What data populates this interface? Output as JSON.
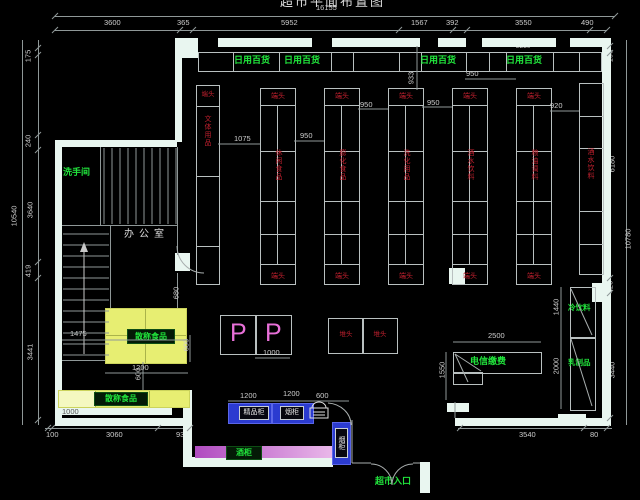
{
  "title_partial": "超市平面布置图",
  "colors": {
    "background": "#000000",
    "wall": "#e9f6f0",
    "line": "#8f9898",
    "green_text": "#21e43c",
    "red_text": "#c0202e",
    "yellow_area": "#e7ee72",
    "blue_counter": "#2b3bd0",
    "magenta_strip": "#c653cc",
    "pink_letter": "#e870d8"
  },
  "dims": {
    "top": {
      "overall": "16155",
      "segments": [
        "3600",
        "365",
        "5952",
        "1567",
        "392",
        "3550",
        "490"
      ],
      "sub": "2250"
    },
    "left": {
      "overall": "10540",
      "segments": [
        "175",
        "240",
        "3640",
        "419",
        "3441"
      ]
    },
    "right": {
      "overall": "10780",
      "segments": [
        "190",
        "6180",
        "420",
        "3440"
      ]
    },
    "bottom": [
      "100",
      "3060",
      "935",
      "3540",
      "80"
    ],
    "aisles": {
      "a1": "1075",
      "a2": "950",
      "a3": "950",
      "a4": "950",
      "a5": "950",
      "a6": "920",
      "a7": "933"
    },
    "bulk": {
      "w": "1475",
      "h1": "680",
      "h2": "600",
      "w2": "1200",
      "h3": "600",
      "strip": "1000"
    },
    "promo": "1000",
    "checkout": [
      "1200",
      "1200",
      "600"
    ],
    "telecom": {
      "w": "2500",
      "h": "1550"
    },
    "cabinets": {
      "cold": "1440",
      "dairy": "2000"
    }
  },
  "labels": {
    "restroom": "洗手间",
    "office": "办公室",
    "daily": [
      "日用百货",
      "日用百货",
      "日用百货",
      "日用百货"
    ],
    "cold_drinks": "冷饮料",
    "dairy": "乳制品",
    "telecom": "电信缴费",
    "bulk_block": "散称食品",
    "bulk_strip": "散称食品",
    "wine": "酒柜",
    "boutique": "精品柜",
    "cigarette": "烟柜",
    "cigarette_vertical": "烟柜",
    "entrance": "超市入口",
    "p1": "P",
    "p2": "P"
  },
  "shelves": {
    "left_wall": {
      "end": "端头",
      "category": "文体用品"
    },
    "right_wall": {
      "category": "酒水饮料"
    },
    "gondolas": [
      {
        "end": "端头",
        "category": "休闲食品",
        "foot": "端头"
      },
      {
        "end": "端头",
        "category": "膨化食品",
        "foot": "端头"
      },
      {
        "end": "端头",
        "category": "洗化用品",
        "foot": "端头"
      },
      {
        "end": "端头",
        "category": "酒水饮料",
        "foot": "端头"
      },
      {
        "end": "端头",
        "category": "粮油调料",
        "foot": "端头"
      }
    ],
    "stacks": [
      "堆头",
      "堆头"
    ]
  }
}
